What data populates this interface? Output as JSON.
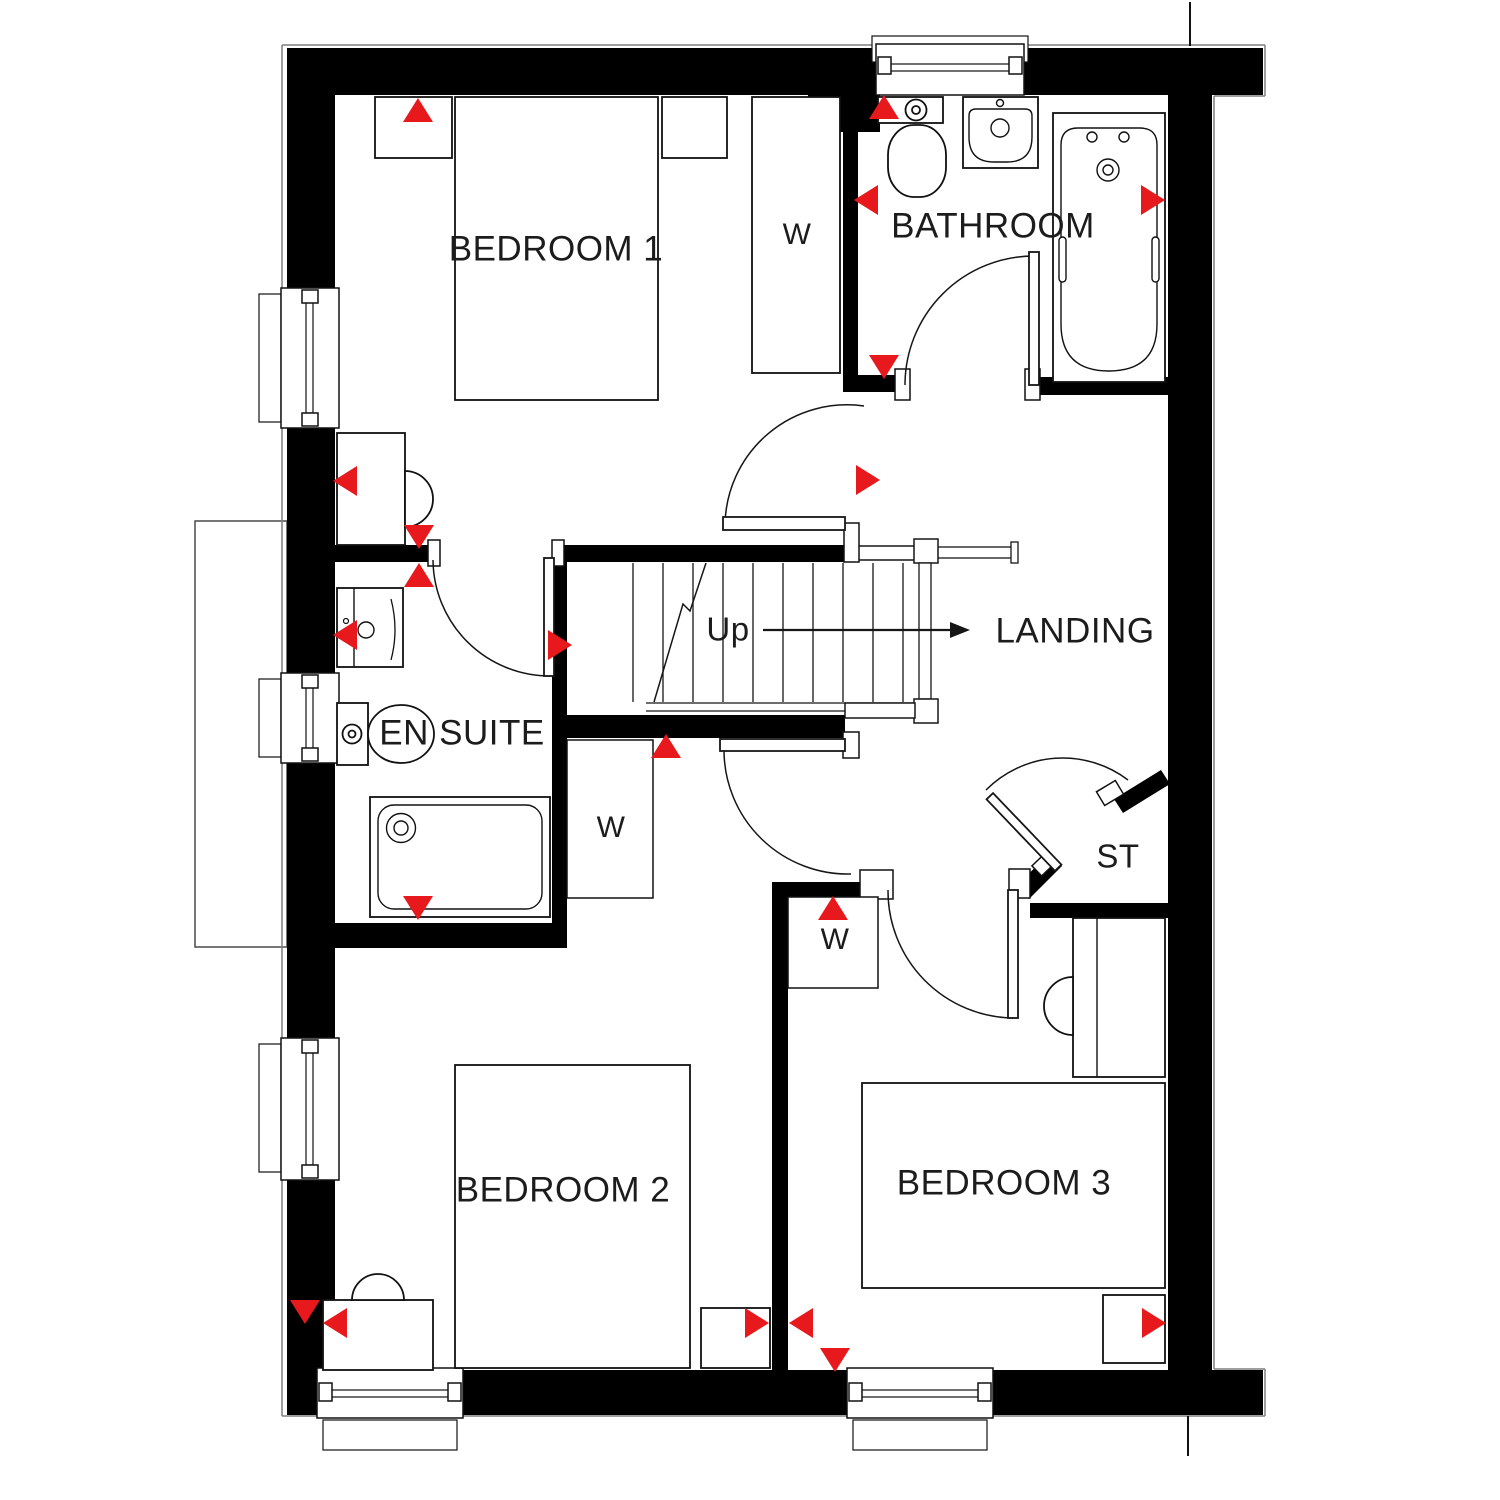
{
  "colors": {
    "wall_black": "#000000",
    "marker_red": "#e8191c",
    "line_dark": "#161616",
    "outline_grey": "#7f7f7f",
    "background": "#ffffff"
  },
  "labels": [
    {
      "id": "bedroom-1",
      "text": "BEDROOM 1",
      "x": 556,
      "y": 249,
      "size": 35
    },
    {
      "id": "bathroom",
      "text": "BATHROOM",
      "x": 993,
      "y": 226,
      "size": 35
    },
    {
      "id": "wardrobe-bedroom-1",
      "text": "W",
      "x": 797,
      "y": 235,
      "size": 30
    },
    {
      "id": "landing",
      "text": "LANDING",
      "x": 1075,
      "y": 631,
      "size": 35
    },
    {
      "id": "stairs-up",
      "text": "Up",
      "x": 728,
      "y": 629,
      "size": 33
    },
    {
      "id": "en-suite",
      "text": "EN SUITE",
      "x": 462,
      "y": 733,
      "size": 35
    },
    {
      "id": "wardrobe-bedroom-2",
      "text": "W",
      "x": 611,
      "y": 828,
      "size": 30
    },
    {
      "id": "store",
      "text": "ST",
      "x": 1118,
      "y": 856,
      "size": 33
    },
    {
      "id": "wardrobe-bedroom-3",
      "text": "W",
      "x": 835,
      "y": 940,
      "size": 30
    },
    {
      "id": "bedroom-2",
      "text": "BEDROOM 2",
      "x": 563,
      "y": 1190,
      "size": 35
    },
    {
      "id": "bedroom-3",
      "text": "BEDROOM 3",
      "x": 1004,
      "y": 1183,
      "size": 35
    }
  ],
  "markers": [
    {
      "dir": "up",
      "x": 418,
      "y": 110
    },
    {
      "dir": "up",
      "x": 884,
      "y": 107
    },
    {
      "dir": "left",
      "x": 866,
      "y": 200
    },
    {
      "dir": "right",
      "x": 1153,
      "y": 200
    },
    {
      "dir": "down",
      "x": 884,
      "y": 367
    },
    {
      "dir": "right",
      "x": 868,
      "y": 480
    },
    {
      "dir": "left",
      "x": 345,
      "y": 481
    },
    {
      "dir": "down",
      "x": 419,
      "y": 537
    },
    {
      "dir": "up",
      "x": 419,
      "y": 575
    },
    {
      "dir": "left",
      "x": 345,
      "y": 635
    },
    {
      "dir": "right",
      "x": 560,
      "y": 645
    },
    {
      "dir": "up",
      "x": 666,
      "y": 746
    },
    {
      "dir": "down",
      "x": 418,
      "y": 908
    },
    {
      "dir": "up",
      "x": 833,
      "y": 908
    },
    {
      "dir": "down",
      "x": 305,
      "y": 1312
    },
    {
      "dir": "left",
      "x": 335,
      "y": 1323
    },
    {
      "dir": "right",
      "x": 757,
      "y": 1323
    },
    {
      "dir": "left",
      "x": 801,
      "y": 1323
    },
    {
      "dir": "down",
      "x": 835,
      "y": 1360
    },
    {
      "dir": "right",
      "x": 1154,
      "y": 1323
    }
  ]
}
